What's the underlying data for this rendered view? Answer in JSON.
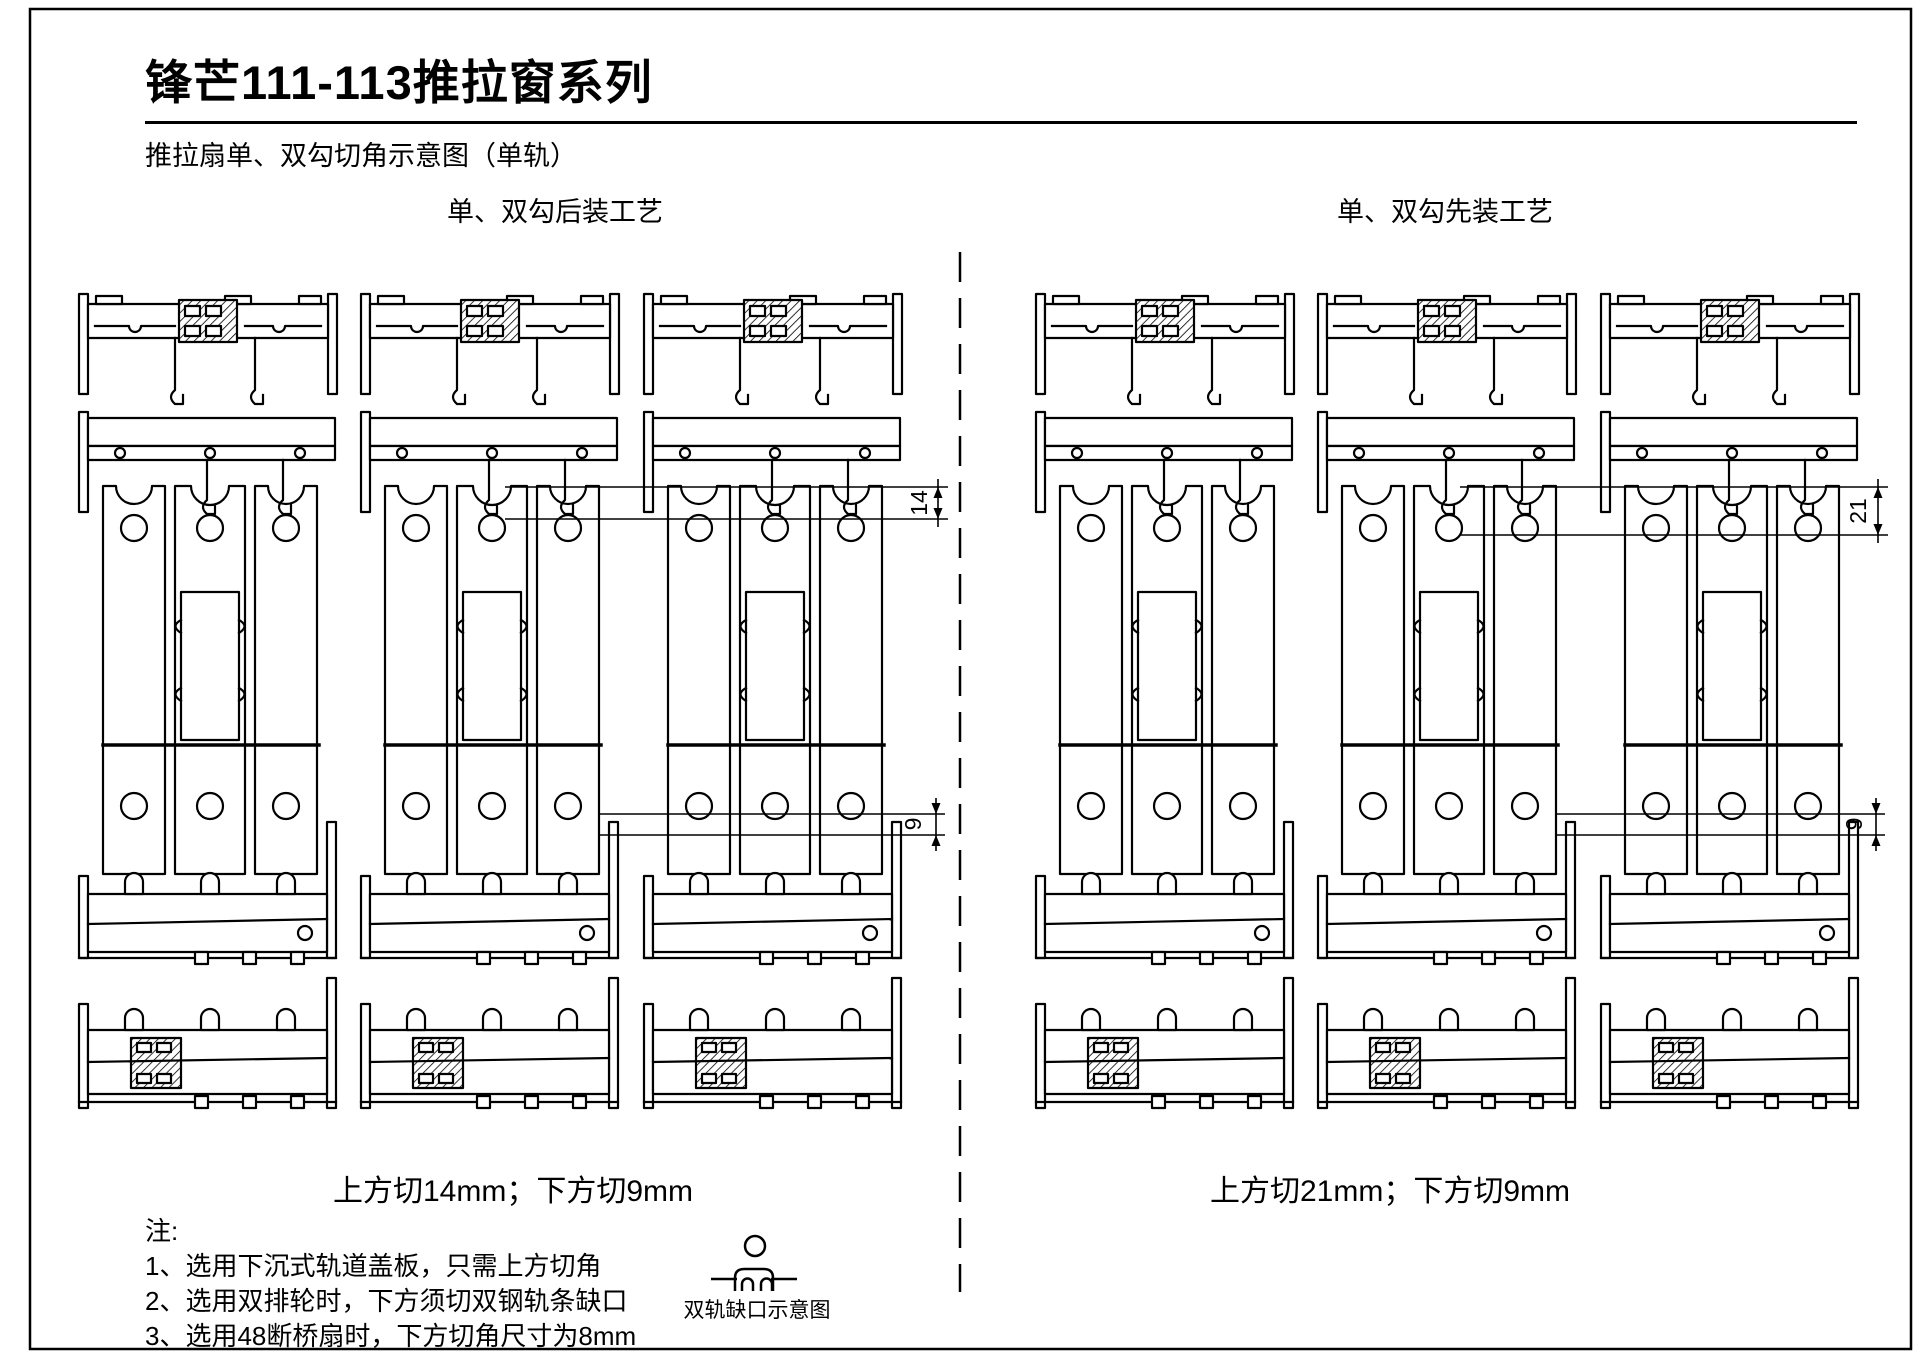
{
  "page": {
    "title": "锋芒111-113推拉窗系列",
    "subtitle": "推拉扇单、双勾切角示意图（单轨）"
  },
  "sections": {
    "left": {
      "header": "单、双勾后装工艺",
      "caption": "上方切14mm；下方切9mm",
      "dim_top": "14",
      "dim_bottom": "9"
    },
    "right": {
      "header": "单、双勾先装工艺",
      "caption": "上方切21mm；下方切9mm",
      "dim_top": "21",
      "dim_bottom": "9"
    }
  },
  "notes": {
    "label": "注:",
    "items": [
      "1、选用下沉式轨道盖板，只需上方切角",
      "2、选用双排轮时，下方须切双钢轨条缺口",
      "3、选用48断桥扇时，下方切角尺寸为8mm"
    ]
  },
  "legend": {
    "label": "双轨缺口示意图"
  },
  "colors": {
    "line": "#000000",
    "background": "#ffffff"
  }
}
